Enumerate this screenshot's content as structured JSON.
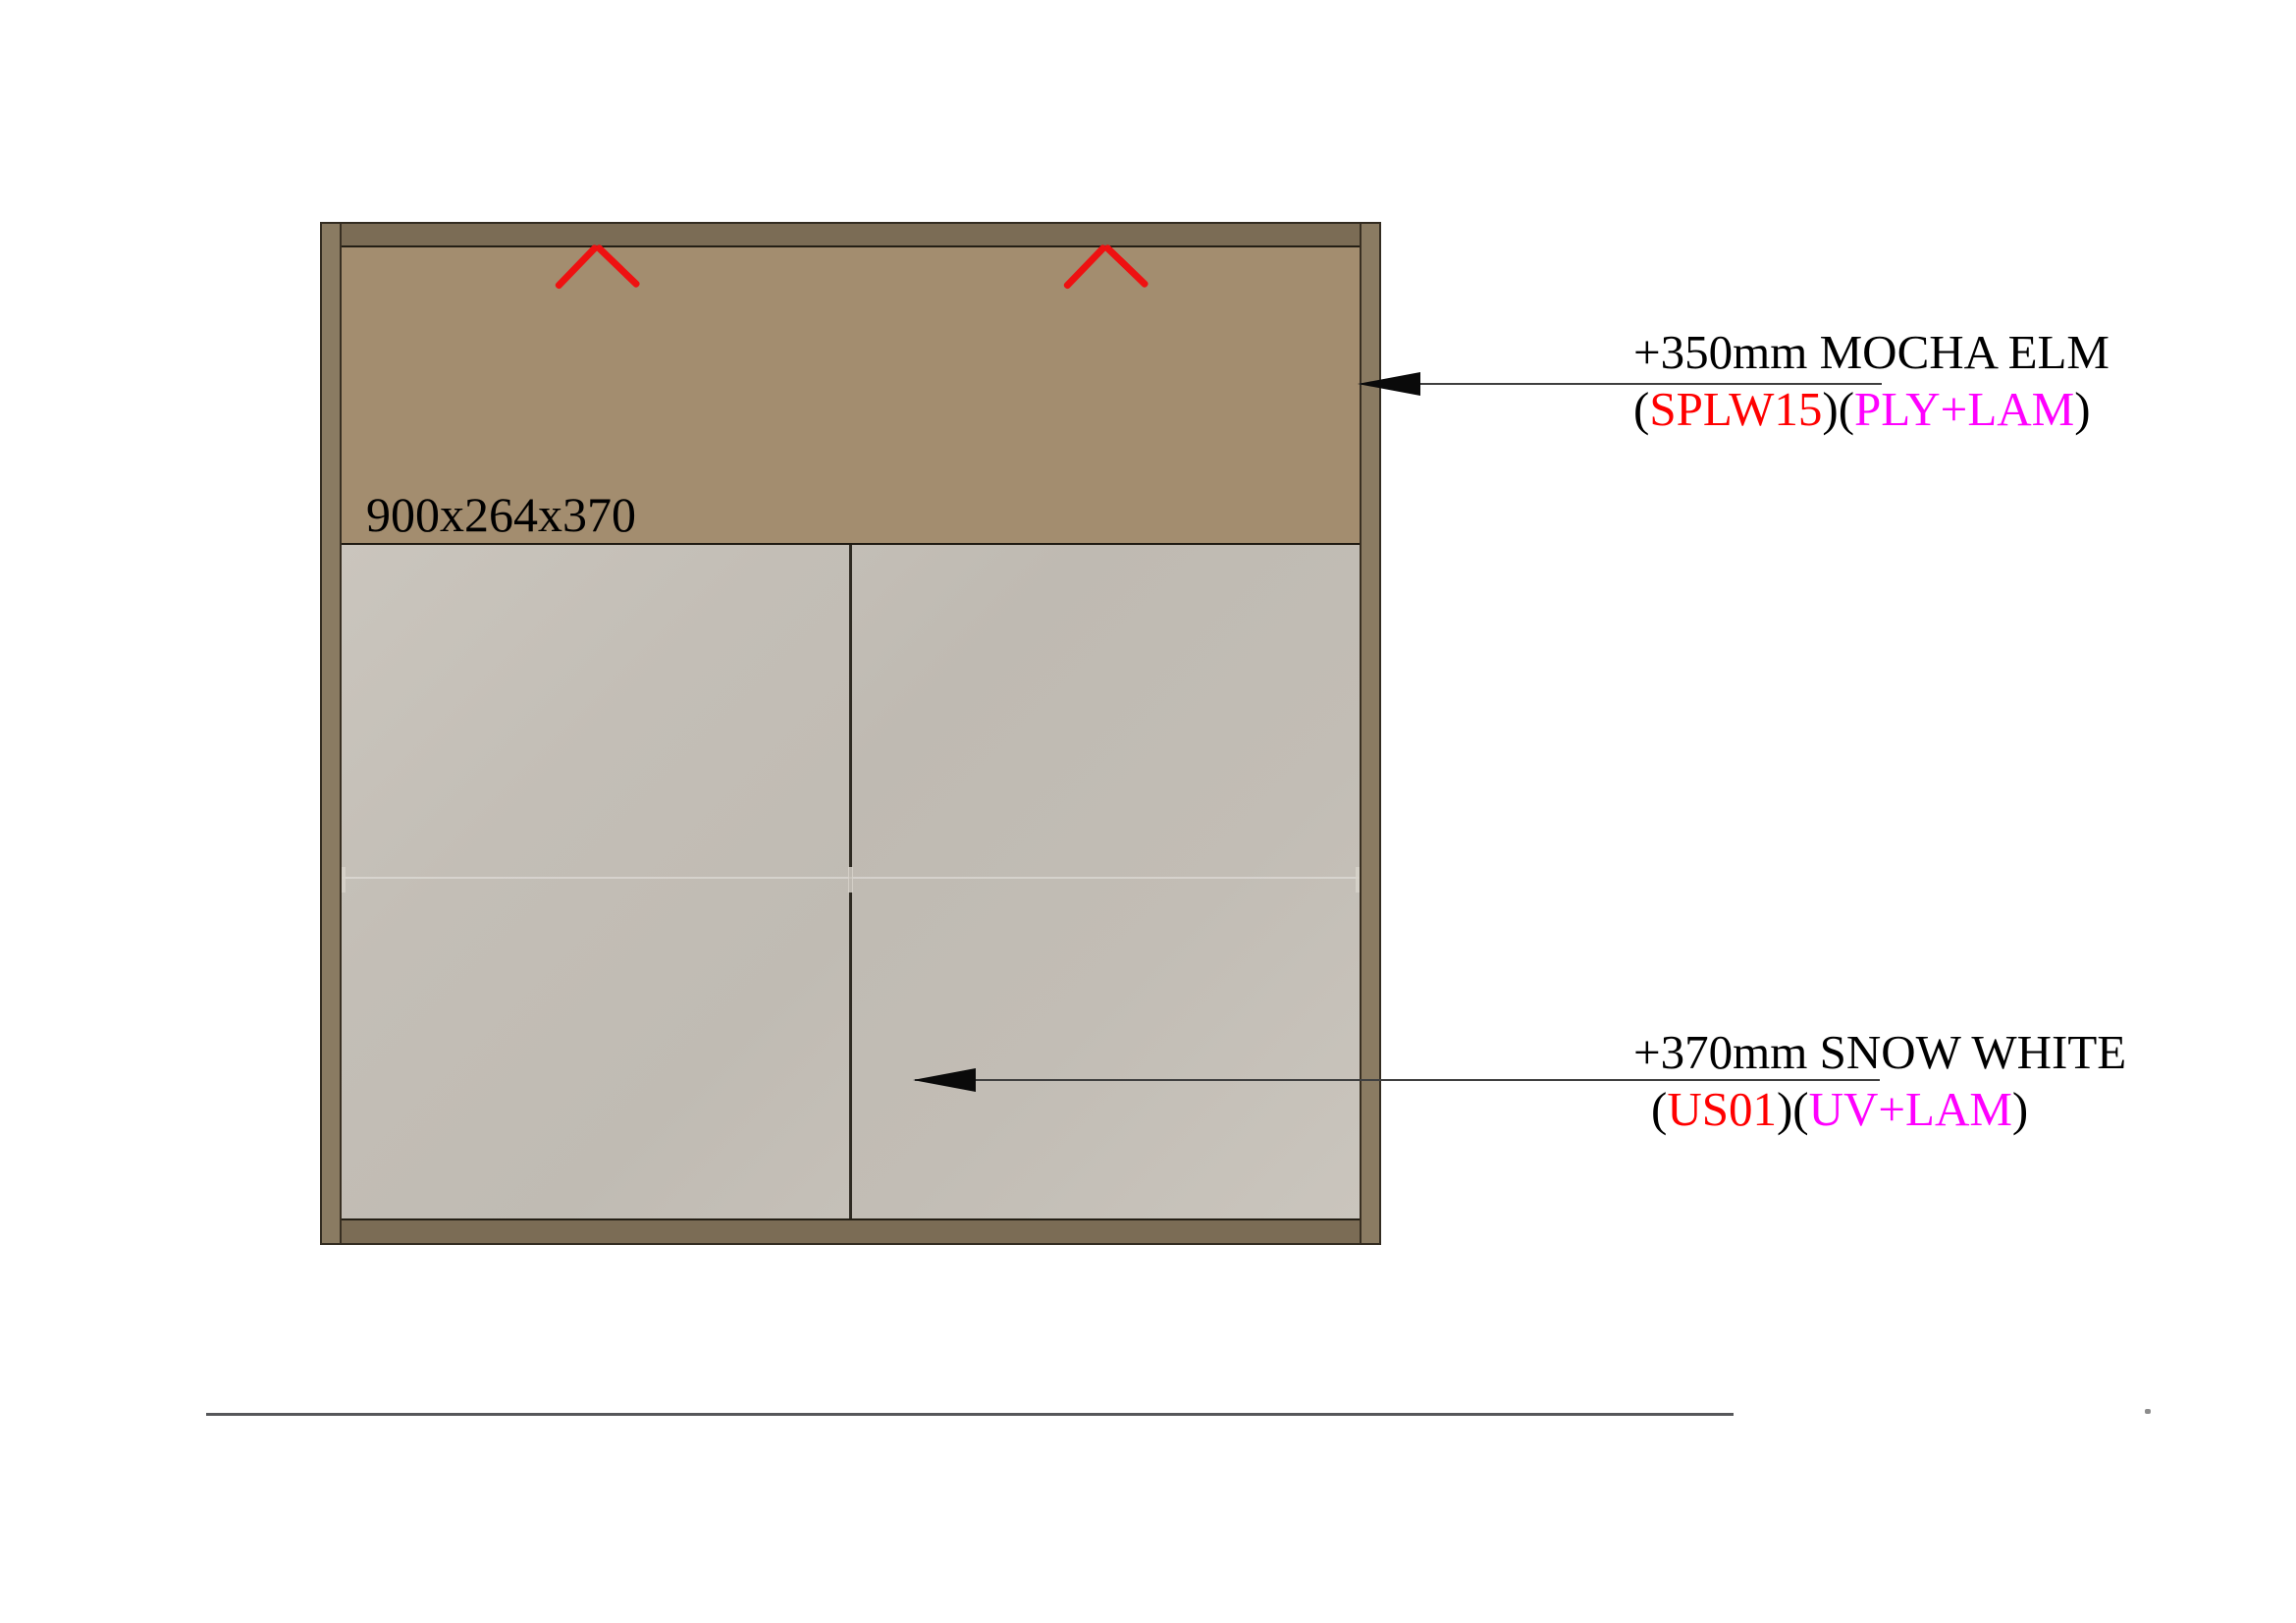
{
  "page": {
    "background_color": "#ffffff"
  },
  "cabinet": {
    "dimension_label": "900x264x370",
    "carcass": {
      "rail_color": "#7b6c55",
      "side_color": "#8a7b62",
      "outline_color": "#332c21"
    },
    "top_panel": {
      "material": "MOCHA ELM",
      "color": "#a38d6f"
    },
    "doors": {
      "material": "SNOW WHITE",
      "count": 2,
      "color": "#c2bdb5"
    },
    "grain_marks": {
      "count": 2,
      "icon": "chevron-up",
      "color": "#ee1111"
    }
  },
  "annotations": {
    "code_color": "#ff0000",
    "finish_color": "#ff00ff",
    "top": {
      "line1": "+350mm MOCHA ELM",
      "line2_parts": [
        {
          "text": "(",
          "color": "#000000"
        },
        {
          "text": "SPLW15",
          "color": "#ff0000"
        },
        {
          "text": ")(",
          "color": "#000000"
        },
        {
          "text": "PLY+LAM",
          "color": "#ff00ff"
        },
        {
          "text": ")",
          "color": "#000000"
        }
      ],
      "leader_icon": "left-arrowhead"
    },
    "bottom": {
      "line1": "+370mm SNOW WHITE",
      "line2_parts": [
        {
          "text": "(",
          "color": "#000000"
        },
        {
          "text": "US01",
          "color": "#ff0000"
        },
        {
          "text": ")(",
          "color": "#000000"
        },
        {
          "text": "UV+LAM",
          "color": "#ff00ff"
        },
        {
          "text": ")",
          "color": "#000000"
        }
      ],
      "leader_icon": "left-arrowhead"
    }
  }
}
